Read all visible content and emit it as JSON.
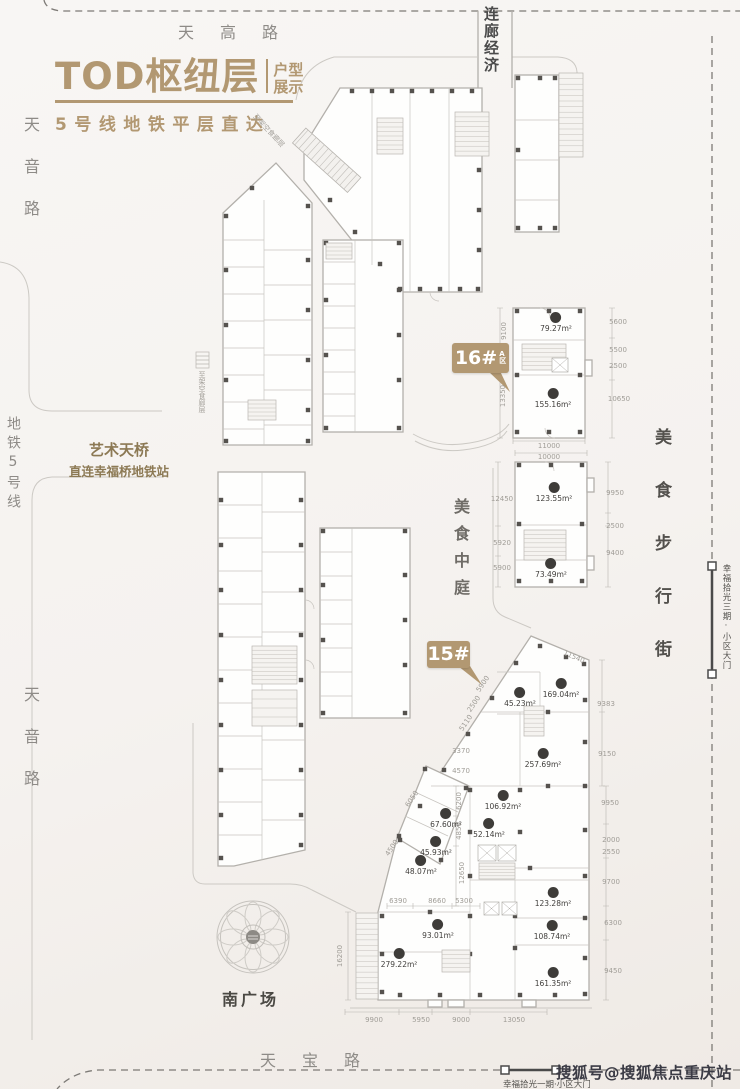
{
  "title": {
    "main": "TOD枢纽层",
    "sub_top": "户型",
    "sub_bottom": "展示",
    "tagline": "5号线地铁平层直达"
  },
  "roads": {
    "top": "天高路",
    "bottom": "天宝路",
    "left_upper": "天音路",
    "left_lower": "天音路",
    "metro": "地铁5号线",
    "corridor": "连廊经济",
    "food_street": "美食步行街",
    "food_atrium": "美食中庭"
  },
  "landmarks": {
    "bridge_line1": "艺术天桥",
    "bridge_line2": "直连幸福桥地铁站",
    "south_plaza": "南广场",
    "ramp_note_diag": "至架空食廊层",
    "ramp_note_vert": "至架空食廊层"
  },
  "callouts": {
    "b16": {
      "number": "16#",
      "zone_top": "A",
      "zone_bottom": "区"
    },
    "b15": {
      "number": "15#"
    }
  },
  "gates": {
    "east": "幸福拾光三期·小区大门",
    "south": "幸福拾光一期·小区大门"
  },
  "watermark": "搜狐号@搜狐焦点重庆站",
  "colors": {
    "gold": "#b29872",
    "road_text": "#8e8b87",
    "dark_text": "#4b4b4b",
    "dim_text": "#a09d97",
    "badge": "#3e3c39"
  },
  "units": [
    {
      "building": "16#A区",
      "area": "79.27m²",
      "x": 556,
      "y": 312
    },
    {
      "building": "16#A区",
      "area": "155.16m²",
      "x": 553,
      "y": 388
    },
    {
      "building": "16#",
      "area": "123.55m²",
      "x": 554,
      "y": 482
    },
    {
      "building": "16#",
      "area": "73.49m²",
      "x": 551,
      "y": 558
    },
    {
      "building": "15#",
      "area": "45.23m²",
      "x": 520,
      "y": 687
    },
    {
      "building": "15#",
      "area": "169.04m²",
      "x": 561,
      "y": 678
    },
    {
      "building": "15#",
      "area": "257.69m²",
      "x": 543,
      "y": 748
    },
    {
      "building": "15#",
      "area": "106.92m²",
      "x": 503,
      "y": 790
    },
    {
      "building": "15#",
      "area": "52.14m²",
      "x": 489,
      "y": 818
    },
    {
      "building": "15#",
      "area": "67.60m²",
      "x": 446,
      "y": 808
    },
    {
      "building": "15#",
      "area": "45.93m²",
      "x": 436,
      "y": 836
    },
    {
      "building": "15#",
      "area": "48.07m²",
      "x": 421,
      "y": 855
    },
    {
      "building": "15#",
      "area": "123.28m²",
      "x": 553,
      "y": 887
    },
    {
      "building": "15#",
      "area": "108.74m²",
      "x": 552,
      "y": 920
    },
    {
      "building": "15#",
      "area": "161.35m²",
      "x": 553,
      "y": 967
    },
    {
      "building": "15#",
      "area": "93.01m²",
      "x": 438,
      "y": 919
    },
    {
      "building": "15#",
      "area": "279.22m²",
      "x": 399,
      "y": 948
    }
  ],
  "dims": [
    {
      "v": "9100",
      "x": 504,
      "y": 331,
      "rot": -90
    },
    {
      "v": "13350",
      "x": 503,
      "y": 396,
      "rot": -90
    },
    {
      "v": "5600",
      "x": 618,
      "y": 322,
      "rot": 0
    },
    {
      "v": "5500",
      "x": 618,
      "y": 350,
      "rot": 0
    },
    {
      "v": "2500",
      "x": 618,
      "y": 366,
      "rot": 0
    },
    {
      "v": "10650",
      "x": 619,
      "y": 399,
      "rot": 0
    },
    {
      "v": "11000",
      "x": 549,
      "y": 446,
      "rot": 0
    },
    {
      "v": "10000",
      "x": 549,
      "y": 457,
      "rot": 0
    },
    {
      "v": "12450",
      "x": 502,
      "y": 499,
      "rot": 0
    },
    {
      "v": "5920",
      "x": 502,
      "y": 543,
      "rot": 0
    },
    {
      "v": "5900",
      "x": 502,
      "y": 568,
      "rot": 0
    },
    {
      "v": "9950",
      "x": 615,
      "y": 493,
      "rot": 0
    },
    {
      "v": "2500",
      "x": 615,
      "y": 526,
      "rot": 0
    },
    {
      "v": "9400",
      "x": 615,
      "y": 553,
      "rot": 0
    },
    {
      "v": "11540",
      "x": 574,
      "y": 657,
      "rot": 23
    },
    {
      "v": "5900",
      "x": 483,
      "y": 684,
      "rot": -56
    },
    {
      "v": "2500",
      "x": 474,
      "y": 704,
      "rot": -56
    },
    {
      "v": "5110",
      "x": 466,
      "y": 723,
      "rot": -56
    },
    {
      "v": "3370",
      "x": 461,
      "y": 751,
      "rot": 0
    },
    {
      "v": "4570",
      "x": 461,
      "y": 771,
      "rot": 0
    },
    {
      "v": "9383",
      "x": 606,
      "y": 704,
      "rot": 0
    },
    {
      "v": "9150",
      "x": 607,
      "y": 754,
      "rot": 0
    },
    {
      "v": "6200",
      "x": 459,
      "y": 801,
      "rot": -90
    },
    {
      "v": "4850",
      "x": 459,
      "y": 831,
      "rot": -90
    },
    {
      "v": "12650",
      "x": 462,
      "y": 873,
      "rot": -90
    },
    {
      "v": "6050",
      "x": 412,
      "y": 799,
      "rot": -56
    },
    {
      "v": "4500",
      "x": 392,
      "y": 848,
      "rot": -56
    },
    {
      "v": "6390",
      "x": 398,
      "y": 901,
      "rot": 0
    },
    {
      "v": "8660",
      "x": 437,
      "y": 901,
      "rot": 0
    },
    {
      "v": "5300",
      "x": 464,
      "y": 901,
      "rot": 0
    },
    {
      "v": "16200",
      "x": 340,
      "y": 956,
      "rot": -90
    },
    {
      "v": "9950",
      "x": 610,
      "y": 803,
      "rot": 0
    },
    {
      "v": "2000",
      "x": 611,
      "y": 840,
      "rot": 0
    },
    {
      "v": "2550",
      "x": 611,
      "y": 852,
      "rot": 0
    },
    {
      "v": "9700",
      "x": 611,
      "y": 882,
      "rot": 0
    },
    {
      "v": "6300",
      "x": 613,
      "y": 923,
      "rot": 0
    },
    {
      "v": "9450",
      "x": 613,
      "y": 971,
      "rot": 0
    },
    {
      "v": "9900",
      "x": 374,
      "y": 1020,
      "rot": 0
    },
    {
      "v": "5950",
      "x": 421,
      "y": 1020,
      "rot": 0
    },
    {
      "v": "9000",
      "x": 461,
      "y": 1020,
      "rot": 0
    },
    {
      "v": "13050",
      "x": 514,
      "y": 1020,
      "rot": 0
    }
  ]
}
